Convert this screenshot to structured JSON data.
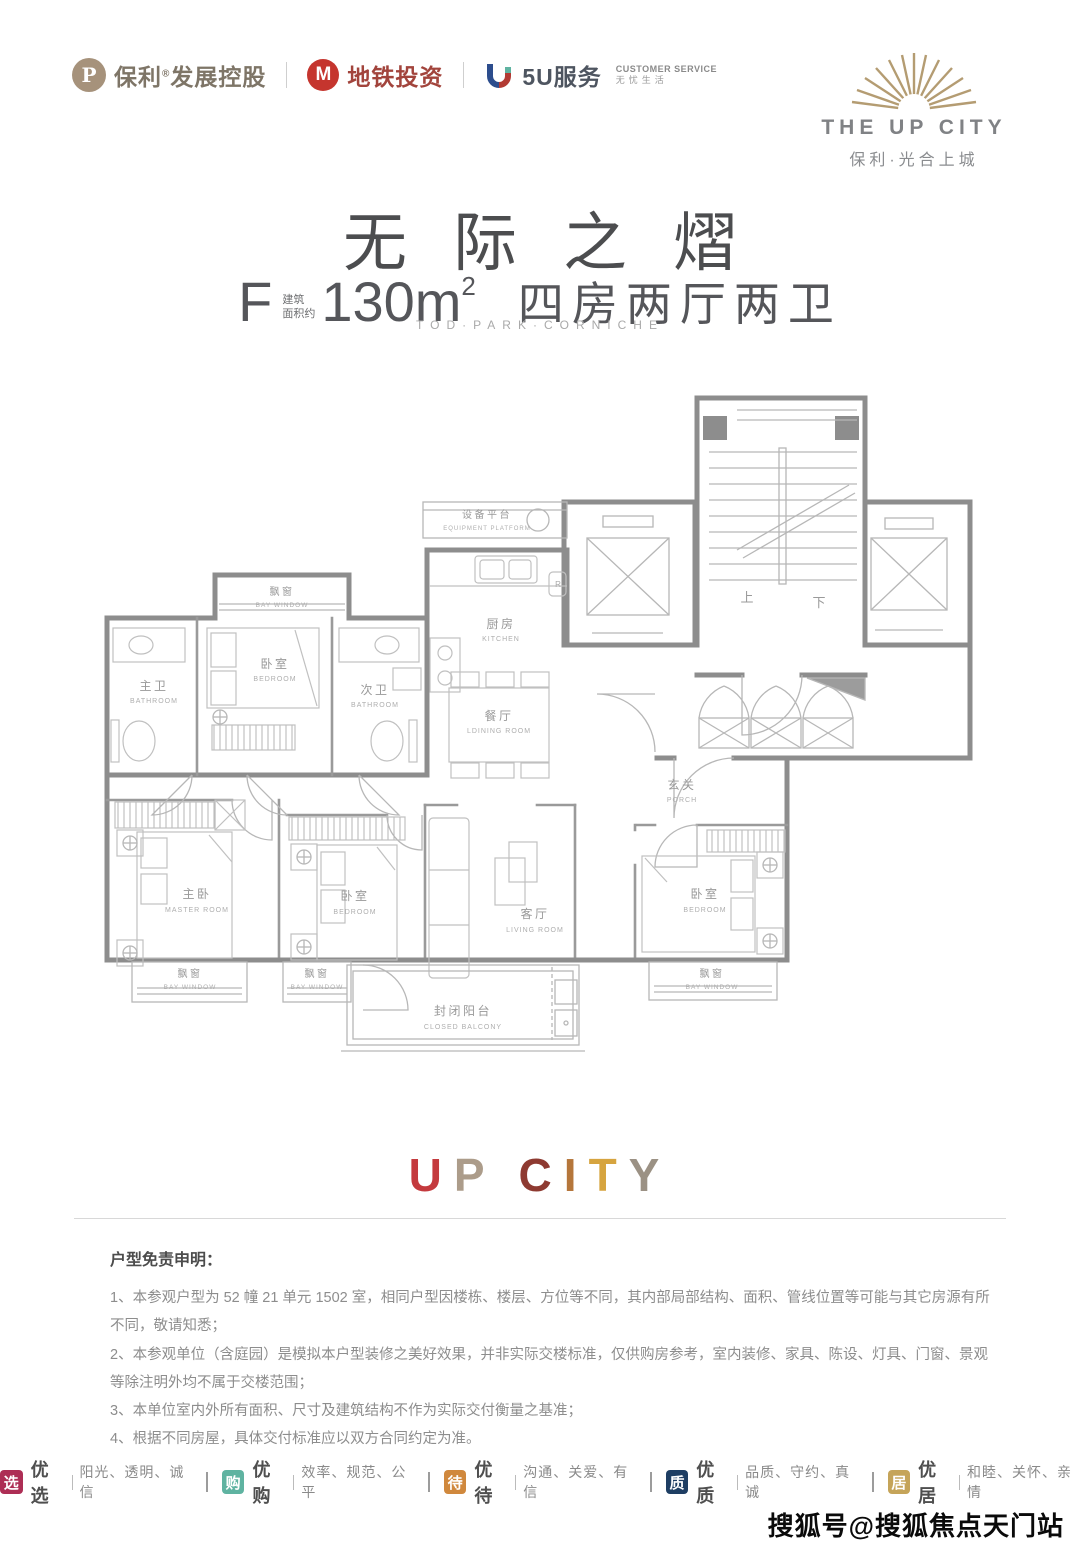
{
  "header": {
    "poly": {
      "mark": "P",
      "name": "保利",
      "reg": "®",
      "suffix": "发展控股"
    },
    "metro": {
      "mark": "M",
      "name": "地铁投资"
    },
    "five_u": {
      "name": "5U服务",
      "cs_line1": "CUSTOMER SERVICE",
      "cs_line2": "无忧生活"
    },
    "brand": {
      "name": "THE UP CITY",
      "cn": "保利·光合上城"
    }
  },
  "title": {
    "main": "无际之熠",
    "type_letter": "F",
    "area_label_line1": "建筑",
    "area_label_line2": "面积约",
    "area_value": "130m",
    "area_sup": "2",
    "layout": "四房两厅两卫",
    "tagline": "TOD·PARK·CORNICHE"
  },
  "floorplan": {
    "rooms": {
      "equipment": {
        "zh": "设备平台",
        "en": "EQUIPMENT PLATFORM"
      },
      "kitchen": {
        "zh": "厨房",
        "en": "KITCHEN"
      },
      "dining": {
        "zh": "餐厅",
        "en": "LDINING ROOM"
      },
      "bedroom_top": {
        "zh": "卧室",
        "en": "BEDROOM"
      },
      "master_bath": {
        "zh": "主卫",
        "en": "BATHROOM"
      },
      "second_bath": {
        "zh": "次卫",
        "en": "BATHROOM"
      },
      "porch": {
        "zh": "玄关",
        "en": "PORCH"
      },
      "master": {
        "zh": "主卧",
        "en": "MASTER ROOM"
      },
      "bedroom_mid": {
        "zh": "卧室",
        "en": "BEDROOM"
      },
      "living": {
        "zh": "客厅",
        "en": "LIVING ROOM"
      },
      "bedroom_right": {
        "zh": "卧室",
        "en": "BEDROOM"
      },
      "balcony": {
        "zh": "封闭阳台",
        "en": "CLOSED BALCONY"
      },
      "bay_top": {
        "zh": "飘窗",
        "en": "BAY WINDOW"
      },
      "bay_left": {
        "zh": "飘窗",
        "en": "BAY WINDOW"
      },
      "bay_mid": {
        "zh": "飘窗",
        "en": "BAY WINDOW"
      },
      "bay_right": {
        "zh": "飘窗",
        "en": "BAY WINDOW"
      }
    },
    "stairs": {
      "up": "上",
      "down": "下"
    },
    "fixtures": {
      "fridge": "R"
    }
  },
  "upcity": {
    "letters": [
      {
        "ch": "U",
        "color": "#c43a3e"
      },
      {
        "ch": "P",
        "color": "#ac9c8a"
      },
      {
        "ch": "C",
        "color": "#8e3a31"
      },
      {
        "ch": "I",
        "color": "#b5763b"
      },
      {
        "ch": "T",
        "color": "#d6a43f"
      },
      {
        "ch": "Y",
        "color": "#9b9184"
      }
    ]
  },
  "disclaimer": {
    "title": "户型免责申明：",
    "items": [
      "1、本参观户型为 52 幢 21 单元 1502 室，相同户型因楼栋、楼层、方位等不同，其内部局部结构、面积、管线位置等可能与其它房源有所不同，敬请知悉；",
      "2、本参观单位（含庭园）是模拟本户型装修之美好效果，并非实际交楼标准，仅供购房参考，室内装修、家具、陈设、灯具、门窗、景观等除注明外均不属于交楼范围；",
      "3、本单位室内外所有面积、尺寸及建筑结构不作为实际交付衡量之基准；",
      "4、根据不同房屋，具体交付标准应以双方合同约定为准。"
    ]
  },
  "badges": [
    {
      "char": "选",
      "color": "#ad2e55",
      "label": "优选",
      "desc": "阳光、透明、诚信"
    },
    {
      "char": "购",
      "color": "#5fb3a1",
      "label": "优购",
      "desc": "效率、规范、公平"
    },
    {
      "char": "待",
      "color": "#d0883d",
      "label": "优待",
      "desc": "沟通、关爱、有信"
    },
    {
      "char": "质",
      "color": "#1e3e63",
      "label": "优质",
      "desc": "品质、守约、真诚"
    },
    {
      "char": "居",
      "color": "#c5a459",
      "label": "优居",
      "desc": "和睦、关怀、亲情"
    }
  ],
  "watermark": "搜狐号@搜狐焦点天门站"
}
